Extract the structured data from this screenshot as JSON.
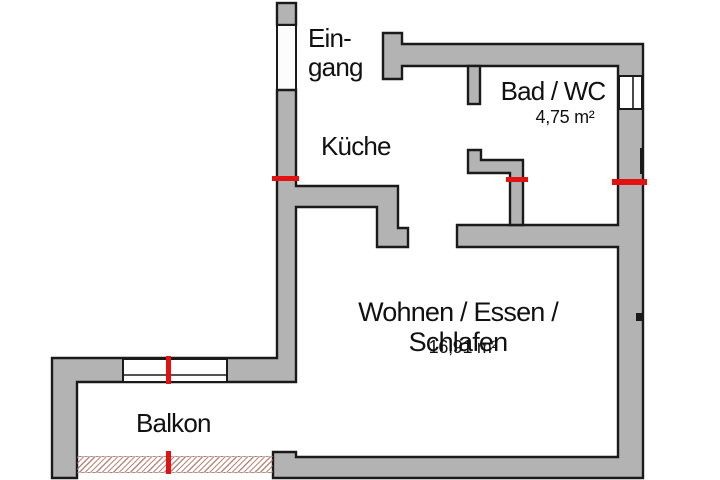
{
  "colors": {
    "background": "#ffffff",
    "wall_fill": "#b3b3b3",
    "outline": "#1a1a1a",
    "marker_red": "#e31212",
    "railing_hatch": "#b08070",
    "text_color": "#111111"
  },
  "rooms": {
    "eingang": {
      "label": "Ein-\ngang"
    },
    "kueche": {
      "label": "Küche"
    },
    "bad": {
      "label": "Bad / WC",
      "area": "4,75 m²"
    },
    "wohnen": {
      "label": "Wohnen / Essen / Schlafen",
      "area": "16,91 m²"
    },
    "balkon": {
      "label": "Balkon"
    }
  }
}
